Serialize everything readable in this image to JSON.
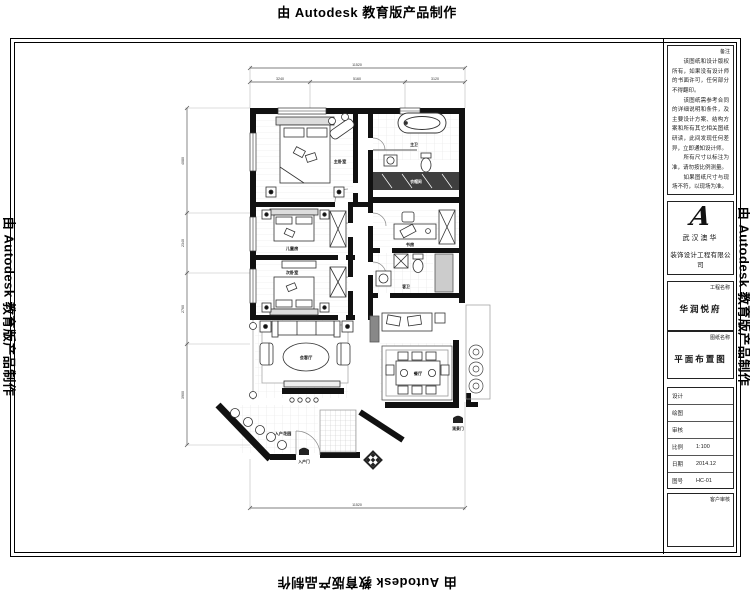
{
  "watermark": {
    "text": "由 Autodesk 教育版产品制作"
  },
  "titleblock": {
    "notes_header": "备注",
    "notes": "　　该图纸和设计版权所有，如果没有设计师的书面许可，任何部分不得翻印。\n　　该图纸需参考合同的详细说明和条件，及主要设计方案、结构方案和所有其它相关图纸研读，此间发现任何差异，立即通知设计师。\n　　所有尺寸以标注为准，请勿按比例测量。\n　　如果图纸尺寸与现场不符，以现场为准。",
    "logo_glyph": "A",
    "company_line1": "武汉澳华",
    "company_line2": "装饰设计工程有限公司",
    "project_label": "工程名称",
    "project_value": "华润悦府",
    "drawing_label": "图纸名称",
    "drawing_value": "平面布置图",
    "fields": [
      {
        "label": "设计",
        "value": ""
      },
      {
        "label": "绘图",
        "value": ""
      },
      {
        "label": "审核",
        "value": ""
      },
      {
        "label": "比例",
        "value": "1:100"
      },
      {
        "label": "日期",
        "value": "2014.12"
      },
      {
        "label": "图号",
        "value": "HC-01"
      }
    ],
    "client_review_label": "客户审核"
  },
  "plan": {
    "rooms": [
      {
        "label": "主卧室"
      },
      {
        "label": "主卫"
      },
      {
        "label": "衣帽间"
      },
      {
        "label": "儿童房"
      },
      {
        "label": "次卧室"
      },
      {
        "label": "书房"
      },
      {
        "label": "客卫"
      },
      {
        "label": "会客厅"
      },
      {
        "label": "餐厅"
      },
      {
        "label": "入户花园"
      },
      {
        "label": "入户门"
      },
      {
        "label": "观景门"
      }
    ],
    "dims": {
      "top_total": "11520",
      "top_segments": [
        "3240",
        "5160",
        "3120"
      ],
      "left_segments": [
        "4080",
        "2340",
        "2760",
        "3900"
      ],
      "bottom_total": "11520"
    }
  }
}
